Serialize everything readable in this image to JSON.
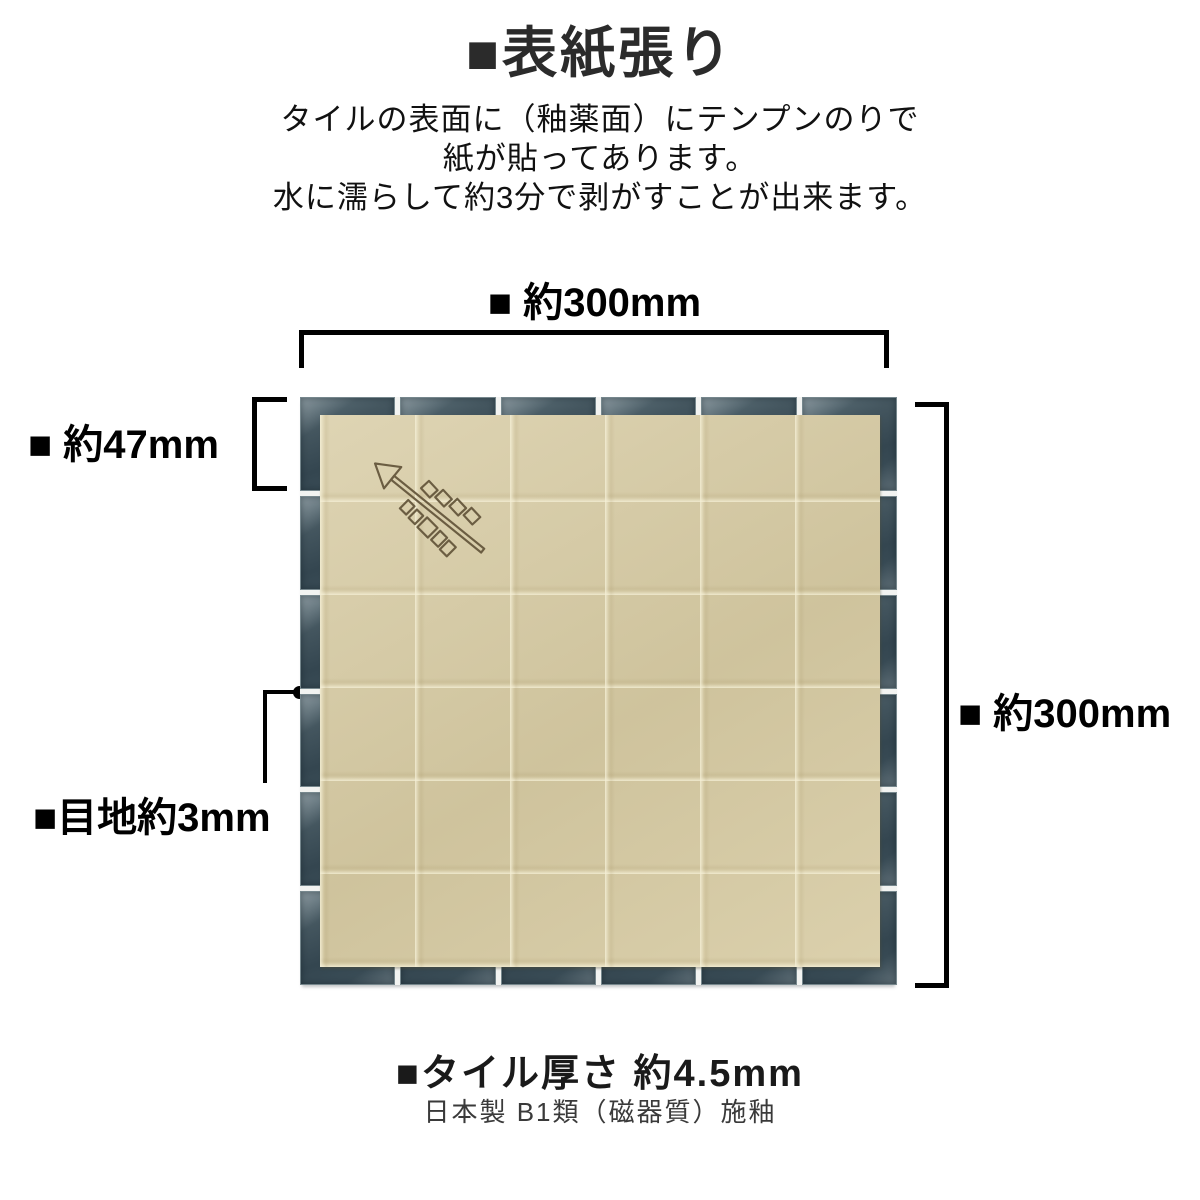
{
  "page": {
    "title": "■表紙張り",
    "description_lines": [
      "タイルの表面に（釉薬面）にテンプンのりで",
      "紙が貼ってあります。",
      "水に濡らして約3分で剥がすことが出来ます。"
    ]
  },
  "diagram": {
    "dim_top_label": "■ 約300mm",
    "dim_left_label": "■ 約47mm",
    "dim_right_label": "■ 約300mm",
    "joint_label": "■目地約3mm",
    "grid": {
      "rows": 6,
      "cols": 6
    },
    "arrow_icon": "direction-arrow-stamp",
    "colors": {
      "tile": "#3f515a",
      "tile_edge": "#76878d",
      "grout": "#f2f3f1",
      "paper": "#d7cba3",
      "arrow_outline": "#6b5d42",
      "bracket": "#000000"
    }
  },
  "footer": {
    "thickness_label": "■タイル厚さ 約4.5mm",
    "origin_label": "日本製 B1類（磁器質）施釉"
  }
}
